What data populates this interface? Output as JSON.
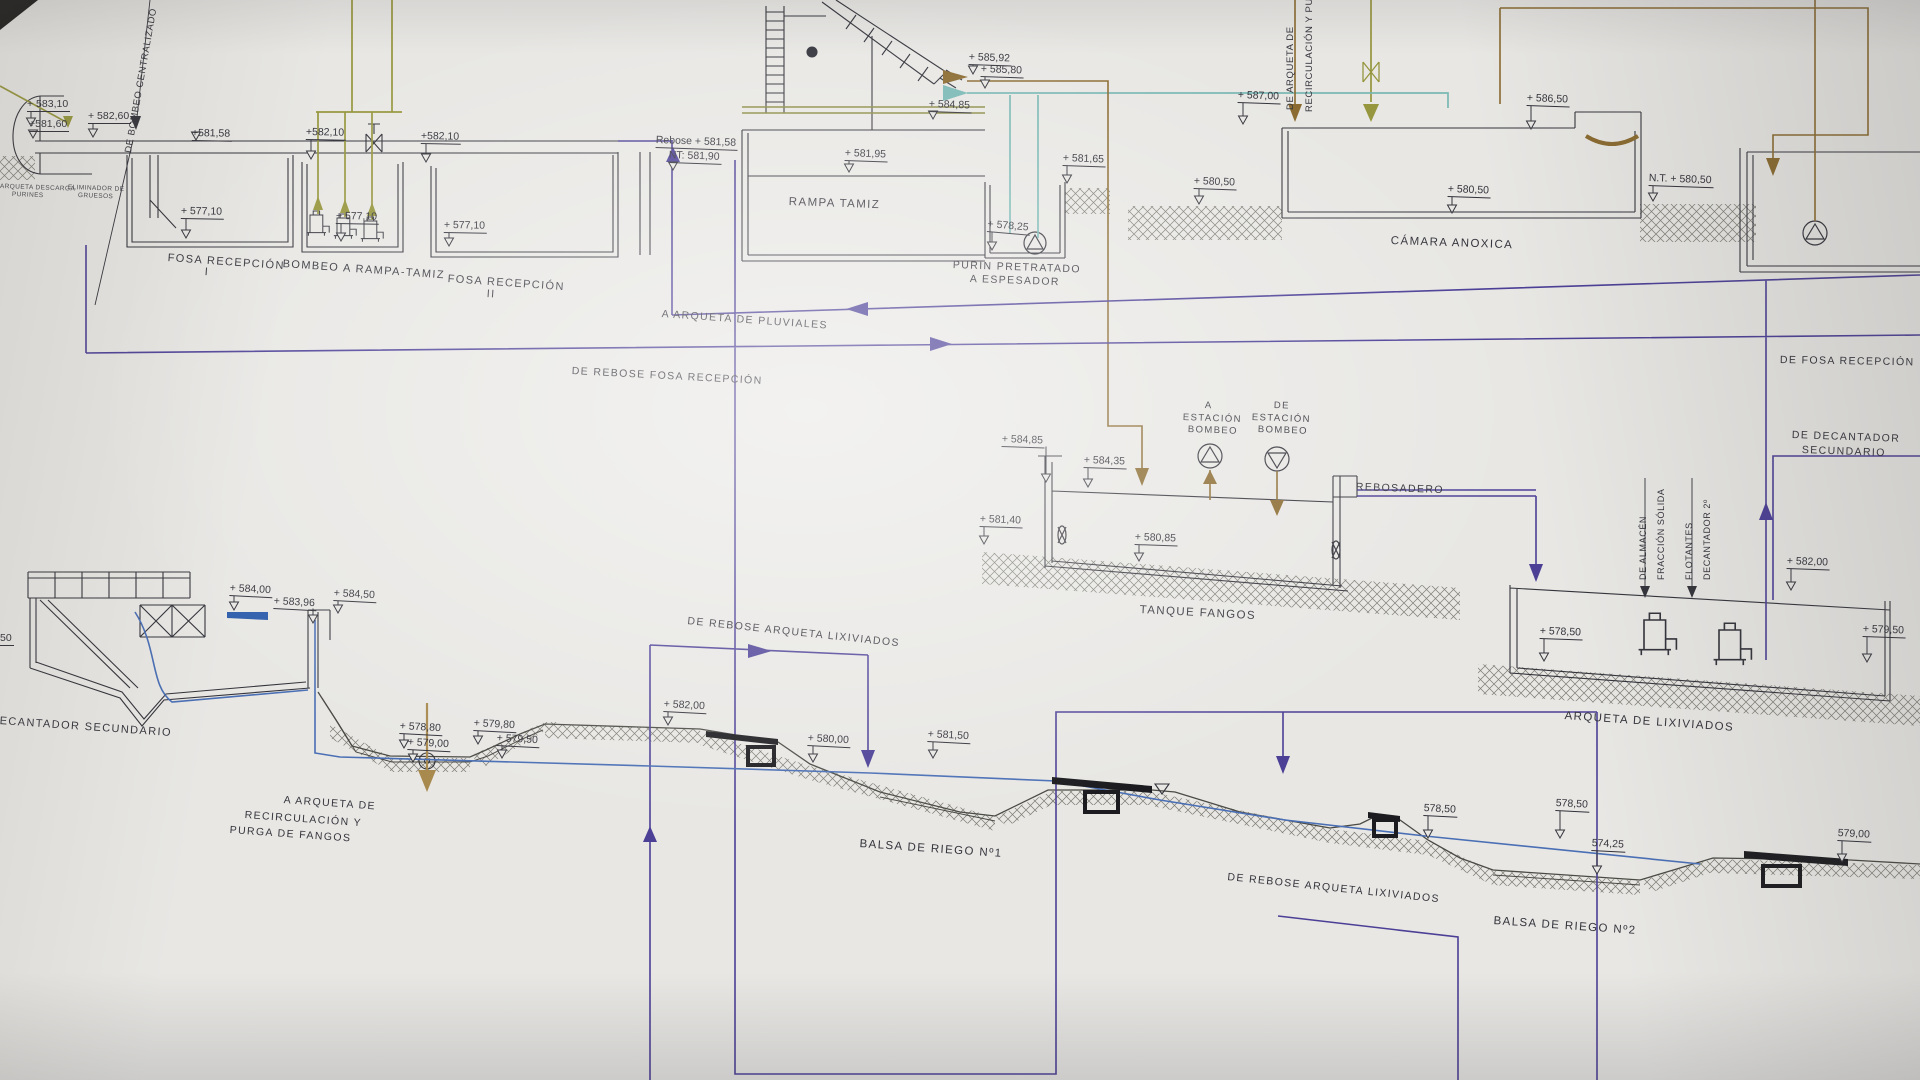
{
  "sheet": {
    "kind": "hydraulic profile blueprint photo",
    "language": "es"
  },
  "colors": {
    "paper": "#e8e7e4",
    "ink": "#33333b",
    "purple": "#4b3f96",
    "blue": "#4a6fb5",
    "water": "#2e5dab",
    "olive": "#96963e",
    "khaki": "#8b8b44",
    "teal": "#79b8b4",
    "brown": "#8a6a2f",
    "tan": "#a8894e",
    "weir_black": "#1c1c20",
    "hatch": "#73736a"
  },
  "labels": [
    {
      "t": "+ 583,10",
      "x": 27,
      "y": 99,
      "s": 10.5,
      "r": 0,
      "k": "e",
      "m": [
        31,
        126
      ],
      "nm": "elev-583-10"
    },
    {
      "t": "+581,60",
      "x": 29,
      "y": 119,
      "s": 10.5,
      "r": 0,
      "k": "e",
      "m": [
        33,
        138
      ],
      "nm": "elev-581-60"
    },
    {
      "t": "+ 582,60",
      "x": 88,
      "y": 111,
      "s": 10.5,
      "r": 0,
      "k": "e",
      "m": [
        93,
        137
      ],
      "nm": "elev-582-60"
    },
    {
      "t": "+581,58",
      "x": 192,
      "y": 128,
      "s": 10.5,
      "r": 1,
      "k": "e",
      "m": [
        196,
        140
      ],
      "nm": "elev-581-58"
    },
    {
      "t": "+ 577,10",
      "x": 181,
      "y": 206,
      "s": 10.5,
      "r": 1,
      "k": "e",
      "m": [
        186,
        238
      ],
      "nm": "elev-577-10-a"
    },
    {
      "t": "+582,10",
      "x": 306,
      "y": 127,
      "s": 10.5,
      "r": 1,
      "k": "e",
      "m": [
        311,
        159
      ],
      "nm": "elev-582-10-a"
    },
    {
      "t": "+ 577,10",
      "x": 336,
      "y": 211,
      "s": 10.5,
      "r": 1,
      "k": "e",
      "m": [
        341,
        241
      ],
      "nm": "elev-577-10-b"
    },
    {
      "t": "+582,10",
      "x": 421,
      "y": 131,
      "s": 10.5,
      "r": 1,
      "k": "e",
      "m": [
        426,
        162
      ],
      "nm": "elev-582-10-b"
    },
    {
      "t": "+ 577,10",
      "x": 444,
      "y": 220,
      "s": 10.5,
      "r": 1,
      "k": "e",
      "m": [
        449,
        246
      ],
      "nm": "elev-577-10-c"
    },
    {
      "t": "Rebose + 581,58",
      "x": 656,
      "y": 135,
      "s": 10.5,
      "r": 2,
      "k": "e",
      "nm": "elev-rebose-581-58"
    },
    {
      "t": "NT: 581,90",
      "x": 669,
      "y": 150,
      "s": 10.5,
      "r": 2,
      "k": "e",
      "m": [
        673,
        170
      ],
      "nm": "elev-nt-581-90"
    },
    {
      "t": "+ 581,95",
      "x": 845,
      "y": 148,
      "s": 10.5,
      "r": 2,
      "k": "e",
      "m": [
        849,
        172
      ],
      "nm": "elev-581-95"
    },
    {
      "t": "+ 584,85",
      "x": 929,
      "y": 99,
      "s": 10.5,
      "r": 2,
      "k": "e",
      "m": [
        933,
        119
      ],
      "nm": "elev-584-85-a"
    },
    {
      "t": "+ 585,92",
      "x": 969,
      "y": 52,
      "s": 10.5,
      "r": 2,
      "k": "e",
      "m": [
        973,
        74
      ],
      "nm": "elev-585-92"
    },
    {
      "t": "+ 585,80",
      "x": 981,
      "y": 64,
      "s": 10.5,
      "r": 2,
      "k": "e",
      "m": [
        985,
        88
      ],
      "nm": "elev-585-80"
    },
    {
      "t": "+ 581,65",
      "x": 1063,
      "y": 153,
      "s": 10.5,
      "r": 2,
      "k": "e",
      "m": [
        1067,
        183
      ],
      "nm": "elev-581-65"
    },
    {
      "t": "+ 578,25",
      "x": 988,
      "y": 219,
      "s": 10.5,
      "r": 5,
      "k": "e",
      "m": [
        992,
        250
      ],
      "nm": "elev-578-25"
    },
    {
      "t": "+ 587,00",
      "x": 1238,
      "y": 90,
      "s": 10.5,
      "r": 2,
      "k": "e",
      "m": [
        1243,
        124
      ],
      "nm": "elev-587-00"
    },
    {
      "t": "+ 580,50",
      "x": 1194,
      "y": 176,
      "s": 10.5,
      "r": 2,
      "k": "e",
      "m": [
        1199,
        204
      ],
      "nm": "elev-580-50-a"
    },
    {
      "t": "+ 580,50",
      "x": 1448,
      "y": 184,
      "s": 10.5,
      "r": 2,
      "k": "e",
      "m": [
        1452,
        213
      ],
      "nm": "elev-580-50-b"
    },
    {
      "t": "+ 586,50",
      "x": 1527,
      "y": 93,
      "s": 10.5,
      "r": 2,
      "k": "e",
      "m": [
        1531,
        129
      ],
      "nm": "elev-586-50"
    },
    {
      "t": "N.T. + 580,50",
      "x": 1649,
      "y": 173,
      "s": 10.5,
      "r": 2,
      "k": "e",
      "m": [
        1653,
        201
      ],
      "nm": "elev-nt-580-50"
    },
    {
      "t": "+ 584,85",
      "x": 1002,
      "y": 434,
      "s": 10.5,
      "r": 2,
      "k": "e",
      "m": [
        1046,
        482
      ],
      "nm": "elev-584-85-b"
    },
    {
      "t": "+ 584,35",
      "x": 1084,
      "y": 455,
      "s": 10.5,
      "r": 2,
      "k": "e",
      "m": [
        1088,
        487
      ],
      "nm": "elev-584-35"
    },
    {
      "t": "+ 581,40",
      "x": 980,
      "y": 514,
      "s": 10.5,
      "r": 2,
      "k": "e",
      "m": [
        984,
        544
      ],
      "nm": "elev-581-40"
    },
    {
      "t": "+ 580,85",
      "x": 1135,
      "y": 532,
      "s": 10.5,
      "r": 2,
      "k": "e",
      "m": [
        1139,
        561
      ],
      "nm": "elev-580-85"
    },
    {
      "t": "+ 582,00",
      "x": 1787,
      "y": 556,
      "s": 10.5,
      "r": 2,
      "k": "e",
      "m": [
        1791,
        590
      ],
      "nm": "elev-582-00-r"
    },
    {
      "t": "+ 578,50",
      "x": 1540,
      "y": 626,
      "s": 10.5,
      "r": 2,
      "k": "e",
      "m": [
        1544,
        661
      ],
      "nm": "elev-578-50-r"
    },
    {
      "t": "+ 579,50",
      "x": 1863,
      "y": 624,
      "s": 10.5,
      "r": 2,
      "k": "e",
      "m": [
        1867,
        662
      ],
      "nm": "elev-579-50-r"
    },
    {
      "t": "+ 584,00",
      "x": 230,
      "y": 583,
      "s": 10.5,
      "r": 3,
      "k": "e",
      "m": [
        234,
        610
      ],
      "nm": "elev-584-00"
    },
    {
      "t": "+ 583,96",
      "x": 274,
      "y": 596,
      "s": 10.5,
      "r": 3,
      "k": "e",
      "m": [
        313,
        623
      ],
      "nm": "elev-583-96"
    },
    {
      "t": "+ 584,50",
      "x": 334,
      "y": 588,
      "s": 10.5,
      "r": 3,
      "k": "e",
      "m": [
        338,
        613
      ],
      "nm": "elev-584-50"
    },
    {
      "t": "+ 578,80",
      "x": 400,
      "y": 721,
      "s": 10.5,
      "r": 3,
      "k": "e",
      "m": [
        404,
        748
      ],
      "nm": "elev-578-80"
    },
    {
      "t": "+ 579,00",
      "x": 408,
      "y": 737,
      "s": 10.5,
      "r": 3,
      "k": "e",
      "m": [
        413,
        762
      ],
      "nm": "elev-579-00"
    },
    {
      "t": "+ 579,80",
      "x": 474,
      "y": 718,
      "s": 10.5,
      "r": 3,
      "k": "e",
      "m": [
        478,
        744
      ],
      "nm": "elev-579-80"
    },
    {
      "t": "+ 579,50",
      "x": 497,
      "y": 733,
      "s": 10.5,
      "r": 3,
      "k": "e",
      "m": [
        502,
        758
      ],
      "nm": "elev-579-50-m"
    },
    {
      "t": "+ 582,00",
      "x": 664,
      "y": 699,
      "s": 10.5,
      "r": 3,
      "k": "e",
      "m": [
        668,
        725
      ],
      "nm": "elev-582-00-m"
    },
    {
      "t": "+ 580,00",
      "x": 808,
      "y": 733,
      "s": 10.5,
      "r": 3,
      "k": "e",
      "m": [
        813,
        762
      ],
      "nm": "elev-580-00"
    },
    {
      "t": "+ 581,50",
      "x": 928,
      "y": 729,
      "s": 10.5,
      "r": 3,
      "k": "e",
      "m": [
        933,
        758
      ],
      "nm": "elev-581-50"
    },
    {
      "t": "578,50",
      "x": 1424,
      "y": 803,
      "s": 10.5,
      "r": 3,
      "k": "e",
      "m": [
        1428,
        838
      ],
      "nm": "elev-578-50-a"
    },
    {
      "t": "578,50",
      "x": 1556,
      "y": 798,
      "s": 10.5,
      "r": 3,
      "k": "e",
      "m": [
        1560,
        838
      ],
      "nm": "elev-578-50-b"
    },
    {
      "t": "574,25",
      "x": 1592,
      "y": 838,
      "s": 10.5,
      "r": 3,
      "k": "e",
      "m": [
        1597,
        874
      ],
      "nm": "elev-574-25"
    },
    {
      "t": "579,00",
      "x": 1838,
      "y": 828,
      "s": 10.5,
      "r": 3,
      "k": "e",
      "m": [
        1842,
        862
      ],
      "nm": "elev-579-00-b"
    },
    {
      "t": "50",
      "x": 0,
      "y": 633,
      "s": 10.5,
      "r": 0,
      "k": "e",
      "nm": "elev-partial-50"
    },
    {
      "t": "FOSA RECEPCIÓN",
      "x": 168,
      "y": 253,
      "s": 11,
      "r": 4,
      "k": "n",
      "nm": "tank-fosa-recepcion-1"
    },
    {
      "t": "I",
      "x": 205,
      "y": 267,
      "s": 11,
      "r": 4,
      "k": "n",
      "nm": "tank-fosa-recepcion-1-num"
    },
    {
      "t": "BOMBEO A RAMPA-TAMIZ",
      "x": 283,
      "y": 259,
      "s": 11,
      "r": 4,
      "k": "n",
      "nm": "tank-bombeo-rampa-tamiz"
    },
    {
      "t": "FOSA RECEPCIÓN",
      "x": 448,
      "y": 274,
      "s": 11,
      "r": 4,
      "k": "n",
      "nm": "tank-fosa-recepcion-2"
    },
    {
      "t": "II",
      "x": 487,
      "y": 289,
      "s": 11,
      "r": 4,
      "k": "n",
      "nm": "tank-fosa-recepcion-2-num"
    },
    {
      "t": "RAMPA TAMIZ",
      "x": 789,
      "y": 196,
      "s": 11.5,
      "r": 2,
      "k": "n",
      "nm": "tank-rampa-tamiz"
    },
    {
      "t": "PURIN PRETRATADO",
      "x": 953,
      "y": 260,
      "s": 10.5,
      "r": 2,
      "k": "n",
      "nm": "tank-purin-pretratado"
    },
    {
      "t": "A ESPESADOR",
      "x": 970,
      "y": 274,
      "s": 10.5,
      "r": 2,
      "k": "n",
      "nm": "tank-purin-espesador"
    },
    {
      "t": "CÁMARA ANOXICA",
      "x": 1391,
      "y": 235,
      "s": 11.5,
      "r": 2,
      "k": "n",
      "nm": "tank-camara-anoxica"
    },
    {
      "t": "TANQUE FANGOS",
      "x": 1140,
      "y": 604,
      "s": 11.5,
      "r": 3,
      "k": "n",
      "nm": "tank-tanque-fangos"
    },
    {
      "t": "REBOSADERO",
      "x": 1356,
      "y": 482,
      "s": 10.5,
      "r": 2,
      "k": "n",
      "nm": "line-rebosadero"
    },
    {
      "t": "A",
      "x": 1205,
      "y": 401,
      "s": 9.5,
      "r": 2,
      "k": "n",
      "nm": "flow-a-estacion-1"
    },
    {
      "t": "ESTACIÓN",
      "x": 1183,
      "y": 413,
      "s": 9.5,
      "r": 2,
      "k": "n",
      "nm": "flow-a-estacion-2"
    },
    {
      "t": "BOMBEO",
      "x": 1188,
      "y": 425,
      "s": 9.5,
      "r": 2,
      "k": "n",
      "nm": "flow-a-estacion-3"
    },
    {
      "t": "DE",
      "x": 1274,
      "y": 401,
      "s": 9.5,
      "r": 2,
      "k": "n",
      "nm": "flow-de-estacion-1"
    },
    {
      "t": "ESTACIÓN",
      "x": 1252,
      "y": 413,
      "s": 9.5,
      "r": 2,
      "k": "n",
      "nm": "flow-de-estacion-2"
    },
    {
      "t": "BOMBEO",
      "x": 1258,
      "y": 425,
      "s": 9.5,
      "r": 2,
      "k": "n",
      "nm": "flow-de-estacion-3"
    },
    {
      "t": "ARQUETA DE LIXIVIADOS",
      "x": 1565,
      "y": 710,
      "s": 11.5,
      "r": 4,
      "k": "n",
      "nm": "tank-arqueta-lixiviados"
    },
    {
      "t": "DE DECANTADOR",
      "x": 1792,
      "y": 430,
      "s": 10.5,
      "r": 2,
      "k": "n",
      "nm": "line-de-decantador-1"
    },
    {
      "t": "SECUNDARIO",
      "x": 1802,
      "y": 445,
      "s": 10.5,
      "r": 2,
      "k": "n",
      "nm": "line-de-decantador-2"
    },
    {
      "t": "DE FOSA RECEPCIÓN",
      "x": 1780,
      "y": 355,
      "s": 10.5,
      "r": 1,
      "k": "n",
      "nm": "line-de-fosa-recepcion"
    },
    {
      "t": "A ARQUETA DE PLUVIALES",
      "x": 662,
      "y": 309,
      "s": 10.5,
      "r": 4,
      "k": "n",
      "nm": "line-a-arqueta-pluviales"
    },
    {
      "t": "DE REBOSE FOSA RECEPCIÓN",
      "x": 572,
      "y": 366,
      "s": 10.5,
      "r": 3,
      "k": "n",
      "nm": "line-rebose-fosa"
    },
    {
      "t": "DE REBOSE ARQUETA LIXIVIADOS",
      "x": 688,
      "y": 616,
      "s": 10.5,
      "r": 6,
      "k": "n",
      "nm": "line-rebose-lixiviados-1"
    },
    {
      "t": "DE REBOSE ARQUETA LIXIVIADOS",
      "x": 1228,
      "y": 872,
      "s": 10.5,
      "r": 6,
      "k": "n",
      "nm": "line-rebose-lixiviados-2"
    },
    {
      "t": "BALSA DE RIEGO Nº1",
      "x": 860,
      "y": 838,
      "s": 11.5,
      "r": 4,
      "k": "n",
      "nm": "pond-balsa-riego-1"
    },
    {
      "t": "BALSA DE RIEGO Nº2",
      "x": 1494,
      "y": 915,
      "s": 11.5,
      "r": 4,
      "k": "n",
      "nm": "pond-balsa-riego-2"
    },
    {
      "t": "ECANTADOR SECUNDARIO",
      "x": 0,
      "y": 716,
      "s": 11,
      "r": 4,
      "k": "n",
      "nm": "tank-decantador-secundario"
    },
    {
      "t": "A ARQUETA DE",
      "x": 284,
      "y": 795,
      "s": 10.5,
      "r": 4,
      "k": "n",
      "nm": "flow-purga-1"
    },
    {
      "t": "RECIRCULACIÓN Y",
      "x": 245,
      "y": 810,
      "s": 10.5,
      "r": 4,
      "k": "n",
      "nm": "flow-purga-2"
    },
    {
      "t": "PURGA DE FANGOS",
      "x": 230,
      "y": 825,
      "s": 10.5,
      "r": 4,
      "k": "n",
      "nm": "flow-purga-3"
    },
    {
      "t": "ARQUETA DESCARGA",
      "x": 0,
      "y": 184,
      "s": 6.5,
      "r": 2,
      "k": "t",
      "nm": "tank-arqueta-descarga-1"
    },
    {
      "t": "PURINES",
      "x": 12,
      "y": 192,
      "s": 6.5,
      "r": 2,
      "k": "t",
      "nm": "tank-arqueta-descarga-2"
    },
    {
      "t": "ELIMINADOR DE",
      "x": 68,
      "y": 185,
      "s": 6.5,
      "r": 2,
      "k": "t",
      "nm": "eliminador-gruesos-1"
    },
    {
      "t": "GRUESOS",
      "x": 78,
      "y": 193,
      "s": 6.5,
      "r": 2,
      "k": "t",
      "nm": "eliminador-gruesos-2"
    },
    {
      "t": "DE BOMBEO CENTRALIZADO",
      "x": 124,
      "y": 152,
      "s": 9.5,
      "r": -80,
      "k": "v",
      "nm": "line-de-bombeo-centralizado"
    },
    {
      "t": "DE ARQUETA DE",
      "x": 1286,
      "y": 110,
      "s": 9.5,
      "r": -90,
      "k": "v",
      "nm": "line-de-arqueta-recirc-1"
    },
    {
      "t": "RECIRCULACIÓN Y PUR",
      "x": 1305,
      "y": 112,
      "s": 9.5,
      "r": -90,
      "k": "v",
      "nm": "line-de-arqueta-recirc-2"
    },
    {
      "t": "DE ALMACÉN",
      "x": 1639,
      "y": 580,
      "s": 9,
      "r": -90,
      "k": "v",
      "nm": "line-de-almacen-1"
    },
    {
      "t": "FRACCIÓN SÓLIDA",
      "x": 1657,
      "y": 580,
      "s": 9,
      "r": -90,
      "k": "v",
      "nm": "line-de-almacen-2"
    },
    {
      "t": "FLOTANTES",
      "x": 1685,
      "y": 580,
      "s": 9,
      "r": -90,
      "k": "v",
      "nm": "line-flotantes-1"
    },
    {
      "t": "DECANTADOR 2º",
      "x": 1703,
      "y": 580,
      "s": 9,
      "r": -90,
      "k": "v",
      "nm": "line-flotantes-2"
    }
  ]
}
